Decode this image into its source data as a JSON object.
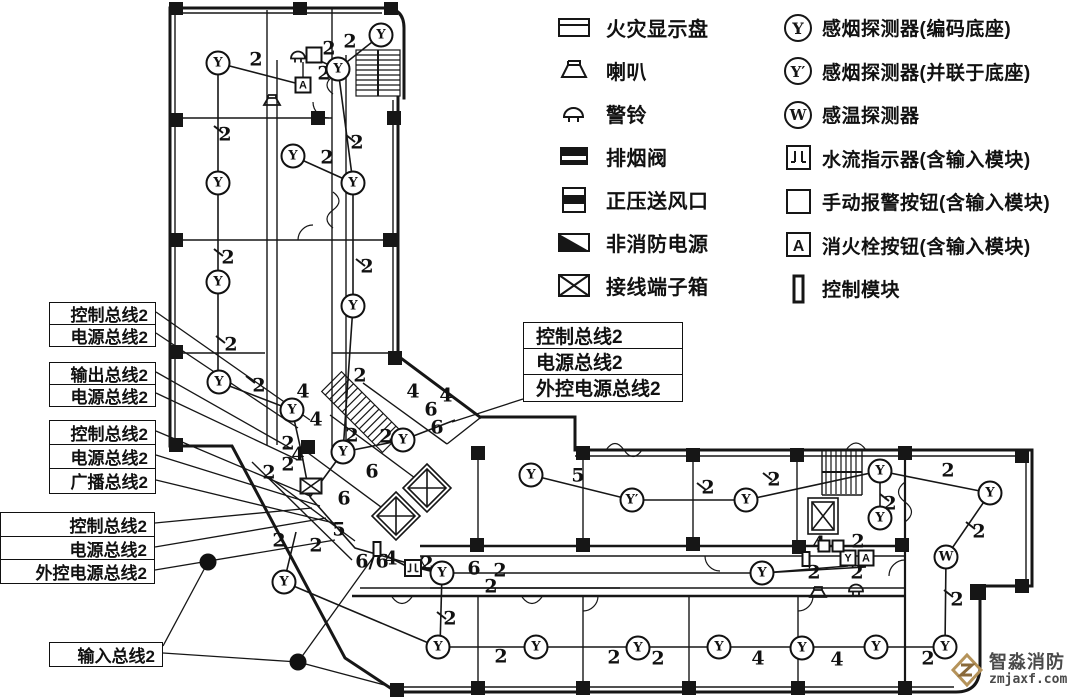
{
  "colors": {
    "ink": "#161616",
    "watermark_logo": "#b5935a",
    "watermark_logo_dark": "#8a6a3b",
    "watermark_text": "#4a4a4a"
  },
  "legend": {
    "left": [
      {
        "icon": "fire-display-panel",
        "label": "火灾显示盘"
      },
      {
        "icon": "speaker",
        "label": "喇叭"
      },
      {
        "icon": "alarm-bell",
        "label": "警铃"
      },
      {
        "icon": "smoke-exhaust-valve",
        "label": "排烟阀"
      },
      {
        "icon": "pressurized-air-outlet",
        "label": "正压送风口"
      },
      {
        "icon": "non-fire-power",
        "label": "非消防电源"
      },
      {
        "icon": "terminal-box",
        "label": "接线端子箱"
      }
    ],
    "right": [
      {
        "icon": "smoke-detector",
        "label": "感烟探测器(编码底座)"
      },
      {
        "icon": "smoke-detector-parallel",
        "label": "感烟探测器(并联于底座)"
      },
      {
        "icon": "heat-detector",
        "label": "感温探测器"
      },
      {
        "icon": "water-flow-indicator",
        "label": "水流指示器(含输入模块)"
      },
      {
        "icon": "manual-call-point",
        "label": "手动报警按钮(含输入模块)"
      },
      {
        "icon": "hydrant-button",
        "label": "消火栓按钮(含输入模块)"
      },
      {
        "icon": "control-module",
        "label": "控制模块"
      }
    ]
  },
  "bus_labels": [
    {
      "id": "g1",
      "x": 49,
      "y": 302,
      "w": 107,
      "row_h": 21.5,
      "mid": false,
      "rows": [
        "控制总线2",
        "电源总线2"
      ]
    },
    {
      "id": "g2",
      "x": 49,
      "y": 362,
      "w": 107,
      "row_h": 21.5,
      "mid": false,
      "rows": [
        "输出总线2",
        "电源总线2"
      ]
    },
    {
      "id": "g3",
      "x": 49,
      "y": 420,
      "w": 107,
      "row_h": 24,
      "mid": false,
      "rows": [
        "控制总线2",
        "电源总线2",
        "广播总线2"
      ]
    },
    {
      "id": "g4",
      "x": 0,
      "y": 512,
      "w": 155,
      "row_h": 23.5,
      "mid": false,
      "rows": [
        "控制总线2",
        "电源总线2",
        "外控电源总线2"
      ]
    },
    {
      "id": "g5",
      "x": 49,
      "y": 642,
      "w": 114,
      "row_h": 23,
      "mid": false,
      "rows": [
        "输入总线2"
      ]
    },
    {
      "id": "mid",
      "x": 523,
      "y": 322,
      "w": 160,
      "row_h": 26,
      "mid": true,
      "rows": [
        "控制总线2",
        "电源总线2",
        "外控电源总线2"
      ]
    }
  ],
  "devices": [
    {
      "type": "smoke",
      "x": 218,
      "y": 63
    },
    {
      "type": "smoke",
      "x": 218,
      "y": 183
    },
    {
      "type": "smoke",
      "x": 218,
      "y": 282
    },
    {
      "type": "smoke",
      "x": 219,
      "y": 382
    },
    {
      "type": "smoke",
      "x": 293,
      "y": 156
    },
    {
      "type": "smoke",
      "x": 338,
      "y": 69
    },
    {
      "type": "smoke",
      "x": 381,
      "y": 35
    },
    {
      "type": "smoke",
      "x": 353,
      "y": 183
    },
    {
      "type": "smoke",
      "x": 353,
      "y": 306
    },
    {
      "type": "smoke",
      "x": 292,
      "y": 410
    },
    {
      "type": "smoke",
      "x": 343,
      "y": 452
    },
    {
      "type": "smoke",
      "x": 403,
      "y": 440
    },
    {
      "type": "smoke",
      "x": 284,
      "y": 582
    },
    {
      "type": "smoke",
      "x": 531,
      "y": 475
    },
    {
      "type": "smokep",
      "x": 632,
      "y": 500
    },
    {
      "type": "smoke",
      "x": 746,
      "y": 500
    },
    {
      "type": "smoke",
      "x": 880,
      "y": 471
    },
    {
      "type": "smoke",
      "x": 880,
      "y": 518
    },
    {
      "type": "smoke",
      "x": 990,
      "y": 493
    },
    {
      "type": "smoke",
      "x": 442,
      "y": 573
    },
    {
      "type": "smoke",
      "x": 762,
      "y": 573
    },
    {
      "type": "smoke",
      "x": 438,
      "y": 647
    },
    {
      "type": "smoke",
      "x": 536,
      "y": 647
    },
    {
      "type": "smoke",
      "x": 638,
      "y": 648
    },
    {
      "type": "smoke",
      "x": 719,
      "y": 647
    },
    {
      "type": "smoke",
      "x": 802,
      "y": 648
    },
    {
      "type": "smoke",
      "x": 876,
      "y": 647
    },
    {
      "type": "smoke",
      "x": 945,
      "y": 647
    },
    {
      "type": "heat",
      "x": 946,
      "y": 557
    },
    {
      "type": "hydrant",
      "x": 303,
      "y": 85
    },
    {
      "type": "hydrant",
      "x": 866,
      "y": 558
    },
    {
      "type": "mcp",
      "x": 314,
      "y": 55
    },
    {
      "type": "mcpy",
      "x": 848,
      "y": 558
    },
    {
      "type": "mcps",
      "x": 824,
      "y": 546
    },
    {
      "type": "mcps",
      "x": 838,
      "y": 546
    },
    {
      "type": "waterflow",
      "x": 413,
      "y": 568
    },
    {
      "type": "module",
      "x": 377,
      "y": 549
    },
    {
      "type": "module",
      "x": 806,
      "y": 559
    },
    {
      "type": "speaker",
      "x": 272,
      "y": 100
    },
    {
      "type": "speaker",
      "x": 818,
      "y": 592
    },
    {
      "type": "bell",
      "x": 298,
      "y": 57
    },
    {
      "type": "bell",
      "x": 856,
      "y": 590
    },
    {
      "type": "termbox",
      "x": 311,
      "y": 486
    }
  ],
  "junctions": [
    {
      "x": 208,
      "y": 562
    },
    {
      "x": 298,
      "y": 662
    }
  ],
  "wire_numbers": [
    {
      "t": "2",
      "x": 256,
      "y": 60
    },
    {
      "t": "2",
      "x": 329,
      "y": 49
    },
    {
      "t": "2",
      "x": 350,
      "y": 42
    },
    {
      "t": "2",
      "x": 324,
      "y": 74
    },
    {
      "t": "2",
      "x": 225,
      "y": 135
    },
    {
      "t": "2",
      "x": 327,
      "y": 158
    },
    {
      "t": "2",
      "x": 357,
      "y": 143
    },
    {
      "t": "2",
      "x": 228,
      "y": 258
    },
    {
      "t": "2",
      "x": 367,
      "y": 267
    },
    {
      "t": "2",
      "x": 231,
      "y": 345
    },
    {
      "t": "2",
      "x": 259,
      "y": 386
    },
    {
      "t": "2",
      "x": 360,
      "y": 376
    },
    {
      "t": "4",
      "x": 303,
      "y": 392
    },
    {
      "t": "4",
      "x": 316,
      "y": 420
    },
    {
      "t": "2",
      "x": 288,
      "y": 444
    },
    {
      "t": "4",
      "x": 298,
      "y": 455
    },
    {
      "t": "2",
      "x": 288,
      "y": 465
    },
    {
      "t": "2",
      "x": 269,
      "y": 473
    },
    {
      "t": "2",
      "x": 352,
      "y": 436
    },
    {
      "t": "2",
      "x": 386,
      "y": 437
    },
    {
      "t": "4",
      "x": 413,
      "y": 392
    },
    {
      "t": "4",
      "x": 446,
      "y": 396
    },
    {
      "t": "6",
      "x": 431,
      "y": 410
    },
    {
      "t": "6",
      "x": 437,
      "y": 428
    },
    {
      "t": "6",
      "x": 344,
      "y": 499
    },
    {
      "t": "6",
      "x": 372,
      "y": 472
    },
    {
      "t": "5",
      "x": 339,
      "y": 530
    },
    {
      "t": "2",
      "x": 316,
      "y": 546
    },
    {
      "t": "6/6",
      "x": 372,
      "y": 562
    },
    {
      "t": "4",
      "x": 391,
      "y": 559
    },
    {
      "t": "2",
      "x": 427,
      "y": 564
    },
    {
      "t": "2",
      "x": 279,
      "y": 541
    },
    {
      "t": "6",
      "x": 474,
      "y": 569
    },
    {
      "t": "2",
      "x": 500,
      "y": 571
    },
    {
      "t": "2",
      "x": 491,
      "y": 587
    },
    {
      "t": "5",
      "x": 578,
      "y": 476
    },
    {
      "t": "2",
      "x": 708,
      "y": 488
    },
    {
      "t": "2",
      "x": 774,
      "y": 480
    },
    {
      "t": "2",
      "x": 948,
      "y": 471
    },
    {
      "t": "2",
      "x": 890,
      "y": 504
    },
    {
      "t": "2",
      "x": 979,
      "y": 532
    },
    {
      "t": "2",
      "x": 957,
      "y": 600
    },
    {
      "t": "2",
      "x": 858,
      "y": 542
    },
    {
      "t": "4",
      "x": 819,
      "y": 544
    },
    {
      "t": "2",
      "x": 814,
      "y": 573
    },
    {
      "t": "2",
      "x": 857,
      "y": 573
    },
    {
      "t": "2",
      "x": 450,
      "y": 619
    },
    {
      "t": "2",
      "x": 501,
      "y": 657
    },
    {
      "t": "2",
      "x": 614,
      "y": 658
    },
    {
      "t": "2",
      "x": 658,
      "y": 659
    },
    {
      "t": "4",
      "x": 758,
      "y": 659
    },
    {
      "t": "4",
      "x": 837,
      "y": 660
    },
    {
      "t": "2",
      "x": 928,
      "y": 659
    }
  ],
  "watermark": {
    "brand": "智淼消防",
    "url": "zmjaxf.com"
  }
}
